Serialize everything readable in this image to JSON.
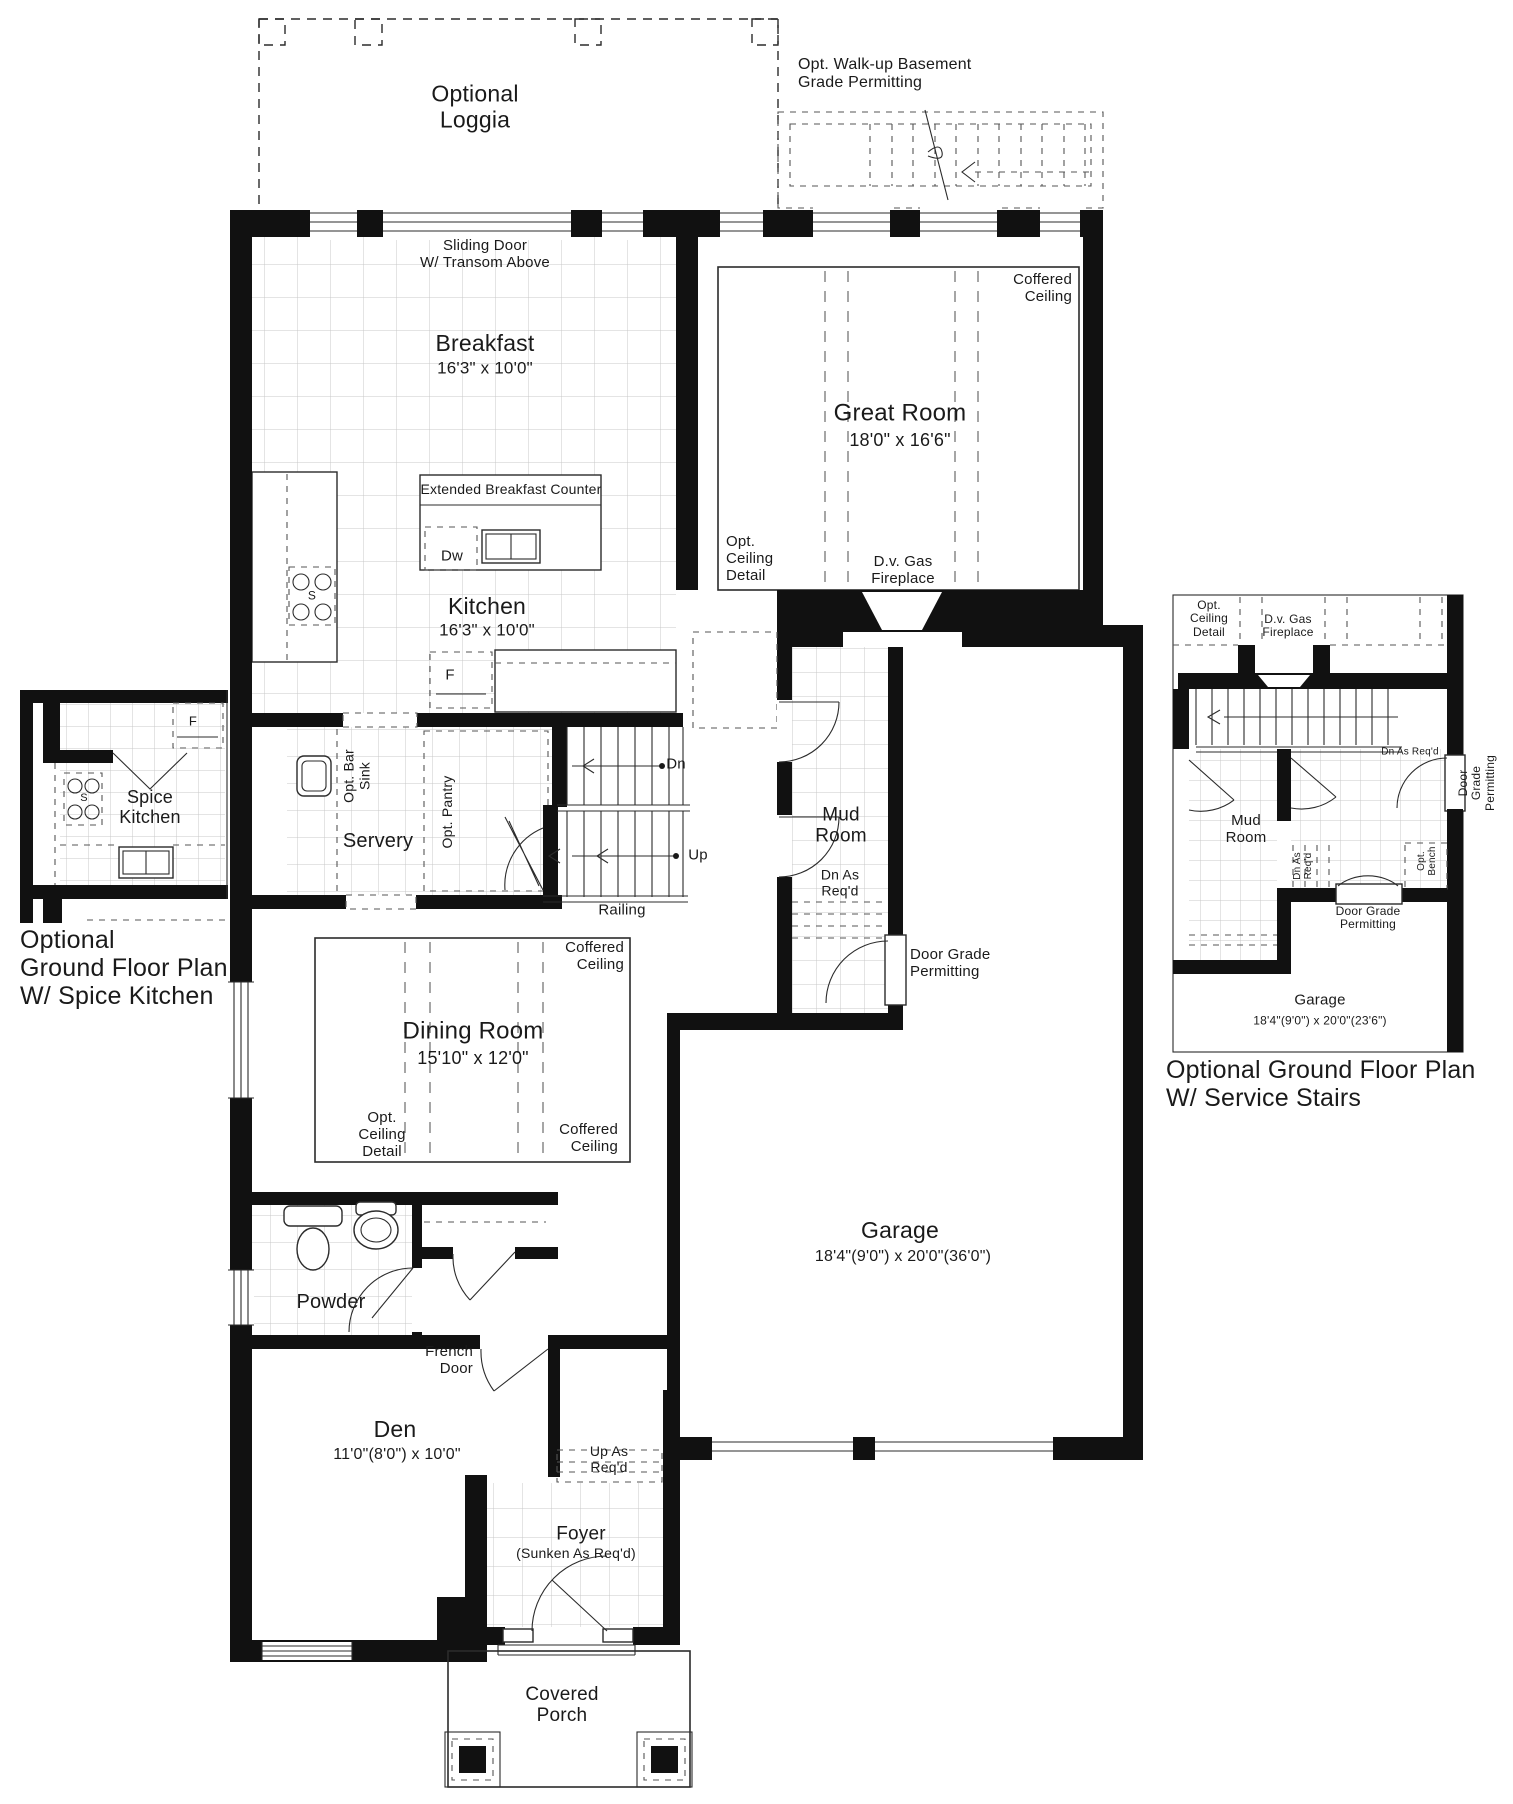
{
  "colors": {
    "wall": "#111111",
    "line": "#2b2b2b",
    "tile": "#c9c9c9",
    "ink": "#1a1a1a",
    "paper": "#ffffff"
  },
  "labels": [
    {
      "name": "loggia-label",
      "text": "Optional\nLoggia",
      "x": 475,
      "y": 107,
      "anchor": "c",
      "size": 23
    },
    {
      "name": "walkup-basement-label",
      "text": "Opt. Walk-up Basement\nGrade Permitting",
      "x": 798,
      "y": 56,
      "anchor": "lt",
      "size": 16
    },
    {
      "name": "sliding-door-label",
      "text": "Sliding Door\nW/ Transom Above",
      "x": 485,
      "y": 238,
      "anchor": "ct",
      "size": 15
    },
    {
      "name": "breakfast-name",
      "text": "Breakfast",
      "x": 485,
      "y": 344,
      "anchor": "c",
      "size": 23
    },
    {
      "name": "breakfast-size",
      "text": "16'3\" x 10'0\"",
      "x": 485,
      "y": 368,
      "anchor": "c",
      "size": 17
    },
    {
      "name": "great-room-coffered-ceiling",
      "text": "Coffered\nCeiling",
      "x": 1072,
      "y": 272,
      "anchor": "rt",
      "size": 15
    },
    {
      "name": "great-room-name",
      "text": "Great Room",
      "x": 900,
      "y": 414,
      "anchor": "c",
      "size": 24
    },
    {
      "name": "great-room-size",
      "text": "18'0\" x 16'6\"",
      "x": 900,
      "y": 440,
      "anchor": "c",
      "size": 18
    },
    {
      "name": "extended-breakfast-counter-label",
      "text": "Extended Breakfast Counter",
      "x": 511,
      "y": 490,
      "anchor": "c",
      "size": 14
    },
    {
      "name": "dishwasher-label",
      "text": "Dw",
      "x": 452,
      "y": 557,
      "anchor": "c",
      "size": 15
    },
    {
      "name": "stove-label",
      "text": "S",
      "x": 312,
      "y": 596,
      "anchor": "c",
      "size": 12
    },
    {
      "name": "kitchen-name",
      "text": "Kitchen",
      "x": 487,
      "y": 607,
      "anchor": "c",
      "size": 23
    },
    {
      "name": "kitchen-size",
      "text": "16'3\" x 10'0\"",
      "x": 487,
      "y": 630,
      "anchor": "c",
      "size": 17
    },
    {
      "name": "fridge-label",
      "text": "F",
      "x": 450,
      "y": 676,
      "anchor": "c",
      "size": 15
    },
    {
      "name": "great-room-opt-ceiling-detail",
      "text": "Opt.\nCeiling\nDetail",
      "x": 726,
      "y": 534,
      "anchor": "lt",
      "size": 15
    },
    {
      "name": "great-room-fireplace-label",
      "text": "D.v. Gas\nFireplace",
      "x": 903,
      "y": 554,
      "anchor": "ct",
      "size": 15
    },
    {
      "name": "opt-bar-sink-label",
      "text": "Opt. Bar\nSink",
      "x": 357,
      "y": 776,
      "anchor": "c",
      "size": 14,
      "rot": true
    },
    {
      "name": "opt-pantry-label",
      "text": "Opt. Pantry",
      "x": 448,
      "y": 812,
      "anchor": "c",
      "size": 14,
      "rot": true
    },
    {
      "name": "servery-name",
      "text": "Servery",
      "x": 378,
      "y": 841,
      "anchor": "c",
      "size": 20
    },
    {
      "name": "stair-dn-label",
      "text": "Dn",
      "x": 676,
      "y": 765,
      "anchor": "c",
      "size": 15
    },
    {
      "name": "stair-up-label",
      "text": "Up",
      "x": 698,
      "y": 856,
      "anchor": "c",
      "size": 15
    },
    {
      "name": "railing-label",
      "text": "Railing",
      "x": 622,
      "y": 911,
      "anchor": "c",
      "size": 15
    },
    {
      "name": "mud-room-name",
      "text": "Mud\nRoom",
      "x": 841,
      "y": 826,
      "anchor": "c",
      "size": 19
    },
    {
      "name": "mud-room-dn-as-reqd",
      "text": "Dn As\nReq'd",
      "x": 840,
      "y": 883,
      "anchor": "c",
      "size": 14
    },
    {
      "name": "door-grade-permitting-label",
      "text": "Door Grade\nPermitting",
      "x": 910,
      "y": 947,
      "anchor": "lt",
      "size": 15
    },
    {
      "name": "dining-coffered-ceiling-tr",
      "text": "Coffered\nCeiling",
      "x": 624,
      "y": 940,
      "anchor": "rt",
      "size": 15
    },
    {
      "name": "dining-room-name",
      "text": "Dining Room",
      "x": 473,
      "y": 1032,
      "anchor": "c",
      "size": 24
    },
    {
      "name": "dining-room-size",
      "text": "15'10\" x 12'0\"",
      "x": 473,
      "y": 1058,
      "anchor": "c",
      "size": 18
    },
    {
      "name": "dining-opt-ceiling-detail",
      "text": "Opt.\nCeiling\nDetail",
      "x": 382,
      "y": 1110,
      "anchor": "ct",
      "size": 15
    },
    {
      "name": "dining-coffered-ceiling-br",
      "text": "Coffered\nCeiling",
      "x": 618,
      "y": 1122,
      "anchor": "rt",
      "size": 15
    },
    {
      "name": "powder-name",
      "text": "Powder",
      "x": 331,
      "y": 1302,
      "anchor": "c",
      "size": 20
    },
    {
      "name": "french-door-label",
      "text": "French\nDoor",
      "x": 473,
      "y": 1344,
      "anchor": "rt",
      "size": 15
    },
    {
      "name": "den-name",
      "text": "Den",
      "x": 395,
      "y": 1430,
      "anchor": "c",
      "size": 23
    },
    {
      "name": "den-size",
      "text": "11'0\"(8'0\") x 10'0\"",
      "x": 397,
      "y": 1455,
      "anchor": "c",
      "size": 16
    },
    {
      "name": "up-as-reqd-label",
      "text": "Up As\nReq'd",
      "x": 609,
      "y": 1444,
      "anchor": "ct",
      "size": 14
    },
    {
      "name": "foyer-name",
      "text": "Foyer",
      "x": 581,
      "y": 1534,
      "anchor": "c",
      "size": 19
    },
    {
      "name": "foyer-sunken-label",
      "text": "(Sunken As Req'd)",
      "x": 576,
      "y": 1554,
      "anchor": "c",
      "size": 14
    },
    {
      "name": "garage-name",
      "text": "Garage",
      "x": 900,
      "y": 1231,
      "anchor": "c",
      "size": 23
    },
    {
      "name": "garage-size",
      "text": "18'4\"(9'0\") x 20'0\"(36'0\")",
      "x": 903,
      "y": 1257,
      "anchor": "c",
      "size": 16
    },
    {
      "name": "covered-porch-name",
      "text": "Covered\nPorch",
      "x": 562,
      "y": 1684,
      "anchor": "ct",
      "size": 19
    },
    {
      "name": "spice-kitchen-fridge-label",
      "text": "F",
      "x": 193,
      "y": 722,
      "anchor": "c",
      "size": 13
    },
    {
      "name": "spice-kitchen-stove-label",
      "text": "S",
      "x": 84,
      "y": 798,
      "anchor": "c",
      "size": 11
    },
    {
      "name": "spice-kitchen-name",
      "text": "Spice\nKitchen",
      "x": 150,
      "y": 807,
      "anchor": "c",
      "size": 18
    },
    {
      "name": "left-inset-caption",
      "text": "Optional\nGround Floor Plan\nW/ Spice Kitchen",
      "x": 20,
      "y": 926,
      "anchor": "lt",
      "size": 25
    },
    {
      "name": "ri-opt-ceiling-detail",
      "text": "Opt.\nCeiling\nDetail",
      "x": 1209,
      "y": 599,
      "anchor": "ct",
      "size": 12
    },
    {
      "name": "ri-fireplace-label",
      "text": "D.v. Gas\nFireplace",
      "x": 1288,
      "y": 613,
      "anchor": "ct",
      "size": 12
    },
    {
      "name": "ri-dn-as-reqd-landing",
      "text": "Dn As Req'd",
      "x": 1410,
      "y": 752,
      "anchor": "c",
      "size": 10
    },
    {
      "name": "ri-door-grade-permitting-v",
      "text": "Door Grade Permitting",
      "x": 1477,
      "y": 783,
      "anchor": "c",
      "size": 12,
      "rot": true
    },
    {
      "name": "ri-mud-room-name",
      "text": "Mud\nRoom",
      "x": 1246,
      "y": 830,
      "anchor": "c",
      "size": 15
    },
    {
      "name": "ri-dn-as-reqd-v",
      "text": "Dn As\nReq'd",
      "x": 1303,
      "y": 866,
      "anchor": "c",
      "size": 10,
      "rot": true
    },
    {
      "name": "ri-opt-bench-v",
      "text": "Opt.\nBench",
      "x": 1427,
      "y": 861,
      "anchor": "c",
      "size": 10,
      "rot": true
    },
    {
      "name": "ri-door-grade-permitting-h",
      "text": "Door Grade\nPermitting",
      "x": 1368,
      "y": 905,
      "anchor": "ct",
      "size": 12
    },
    {
      "name": "ri-garage-name",
      "text": "Garage",
      "x": 1320,
      "y": 1001,
      "anchor": "c",
      "size": 15
    },
    {
      "name": "ri-garage-size",
      "text": "18'4\"(9'0\") x 20'0\"(23'6\")",
      "x": 1320,
      "y": 1021,
      "anchor": "c",
      "size": 12
    },
    {
      "name": "right-inset-caption",
      "text": "Optional Ground Floor Plan\nW/ Service Stairs",
      "x": 1166,
      "y": 1056,
      "anchor": "lt",
      "size": 25
    }
  ]
}
